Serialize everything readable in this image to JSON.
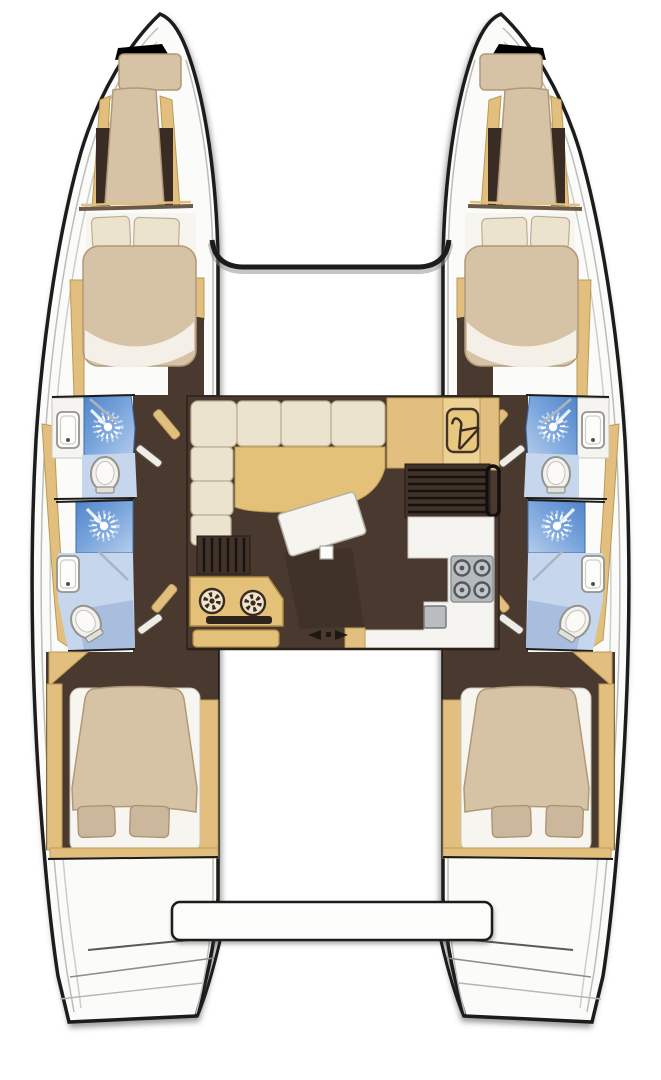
{
  "diagram_type": "catamaran-yacht-floor-plan",
  "rooms": [
    "port-forepeak-berth",
    "starboard-forepeak-berth",
    "port-forward-cabin",
    "starboard-forward-cabin",
    "port-forward-bathroom",
    "port-aft-shower-room",
    "starboard-forward-bathroom",
    "starboard-aft-shower-room",
    "saloon",
    "galley",
    "nav-station",
    "wardrobe",
    "port-aft-cabin",
    "starboard-aft-cabin",
    "cockpit-bench",
    "port-transom-steps",
    "starboard-transom-steps"
  ],
  "fixtures": {
    "double_berths": 4,
    "single_forepeak_berths": 2,
    "showers": 4,
    "toilets": 4,
    "sinks": 4,
    "stove_burners": 4,
    "galley_sink": 1,
    "helm_dials": 2,
    "companionway_stairs": 2,
    "wardrobe_hanger": 1,
    "sliding_door_arrows": 2
  },
  "icons": [
    "shower-head-icon",
    "toilet-icon",
    "sink-icon",
    "coat-hanger-icon",
    "stove-burner-icon",
    "helm-dial-icon",
    "sliding-door-arrows-icon"
  ],
  "colors": {
    "outline": "#1c1c1c",
    "deck": "#fbfbf9",
    "deckline": "#bdbdb8",
    "trim": "#e2bf7e",
    "trimdark": "#bb9a55",
    "floor": "#4a392f",
    "floordark": "#392c24",
    "mattress": "#d6c2a4",
    "mattedge": "#b19877",
    "cushion": "#ece3cf",
    "cushedge": "#bcae92",
    "sheet": "#f7f5f0",
    "tanseat": "#e4c178",
    "blue1": "#5e92d2",
    "blue2": "#aecae9",
    "bathfloor": "#c6d6ec",
    "bathfloor2": "#a9bede",
    "fixture": "#f2f1ed",
    "fixedge": "#94938c",
    "counter": "#f5f4f1",
    "stove": "#b5babd",
    "stovedark": "#53585c",
    "icondark": "#3a2c22"
  }
}
